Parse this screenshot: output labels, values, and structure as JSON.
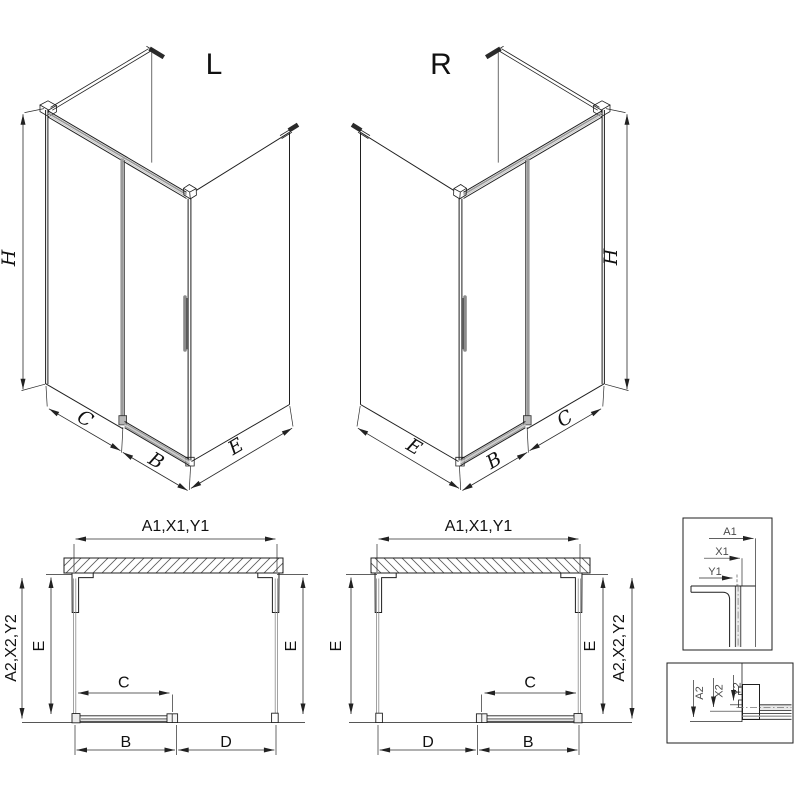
{
  "drawing": {
    "variant_left_label": "L",
    "variant_right_label": "R",
    "dim_height": "H",
    "dim_side": "C",
    "dim_door": "B",
    "dim_depth": "E",
    "dim_opening": "D",
    "dim_wall_top": "A1,X1,Y1",
    "dim_wall_side": "A2,X2,Y2",
    "detail_top_labels": [
      "A1",
      "X1",
      "Y1"
    ],
    "detail_bottom_labels": [
      "A2",
      "X2",
      "Y2"
    ],
    "colors": {
      "line": "#1f1f1f",
      "dimension": "#2b2b2b",
      "glass_grey": "#9a9a9a",
      "background": "#ffffff"
    }
  }
}
